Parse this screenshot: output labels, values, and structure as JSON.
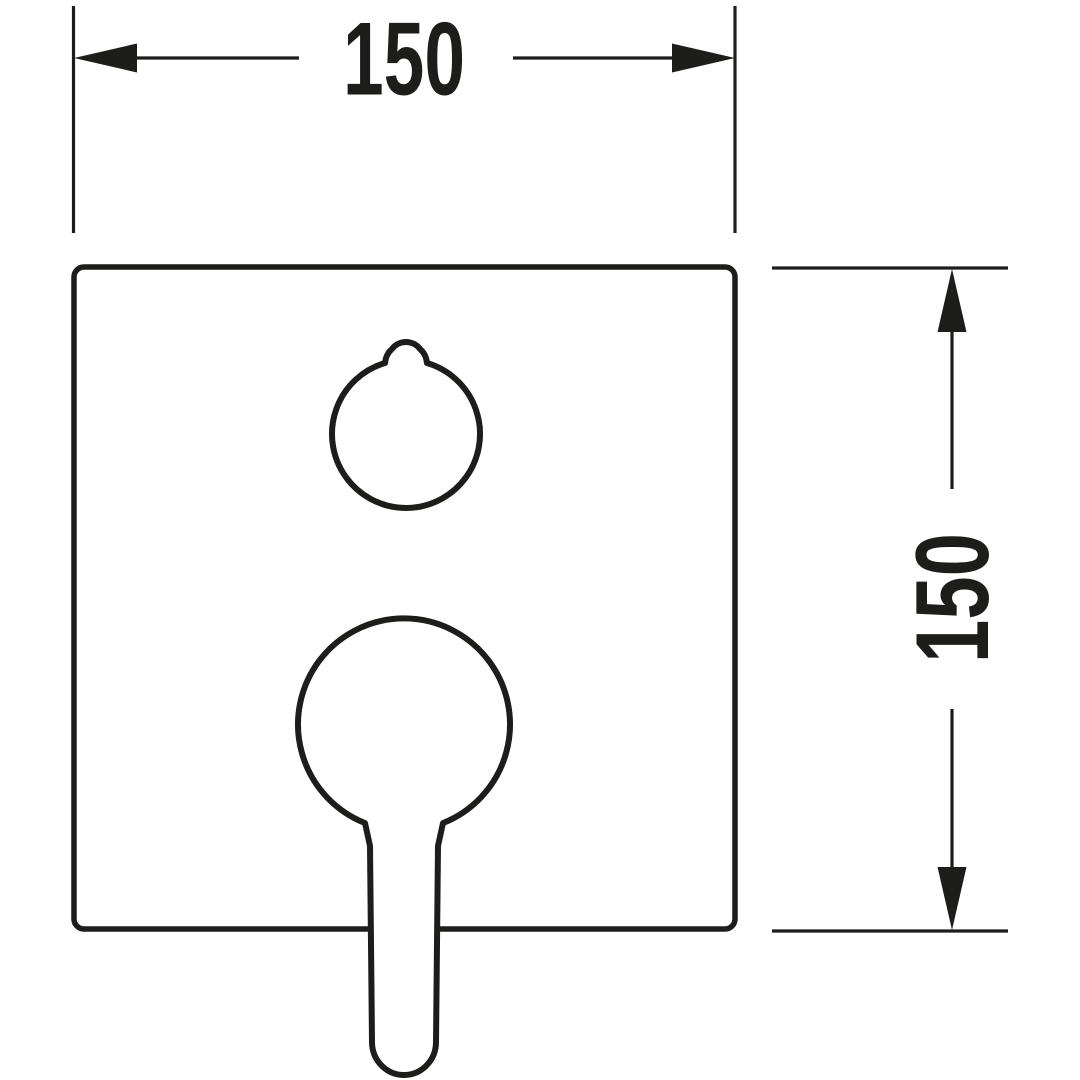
{
  "drawing": {
    "background_color": "#ffffff",
    "line_color": "#1d1d1b",
    "dimensions": {
      "horizontal": {
        "label": "150"
      },
      "vertical": {
        "label": "150"
      }
    }
  }
}
